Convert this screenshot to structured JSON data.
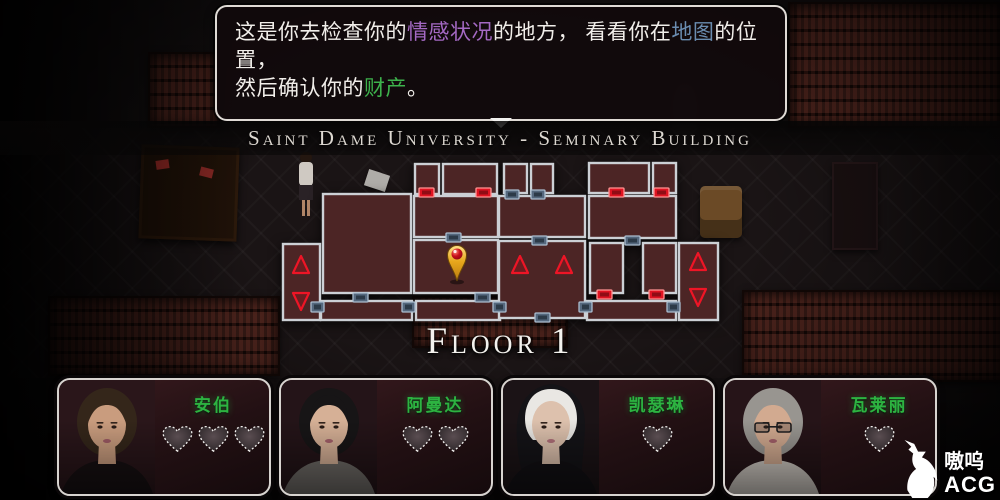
{
  "tooltip": {
    "lines": [
      [
        {
          "text": "这是你去检查你的",
          "color": "#f1eeea"
        },
        {
          "text": "情感状况",
          "color": "#a469c4"
        },
        {
          "text": "的地方， 看看你在",
          "color": "#f1eeea"
        },
        {
          "text": "地图",
          "color": "#6a8cb0"
        },
        {
          "text": "的位置，",
          "color": "#f1eeea"
        }
      ],
      [
        {
          "text": "然后确认你的",
          "color": "#f1eeea"
        },
        {
          "text": "财产",
          "color": "#3db24c"
        },
        {
          "text": "。",
          "color": "#f1eeea"
        }
      ]
    ]
  },
  "header": {
    "building_title": "Saint Dame University - Seminary Building"
  },
  "map": {
    "floor_label": "Floor 1",
    "room_fill": "#4c2525",
    "wall_color": "#ccd0d5",
    "door_red": "#e01422",
    "door_red_edge": "#ff9393",
    "door_red_inner": "#900d15",
    "door_slate": "#55687e",
    "door_slate_edge": "#aabdcf",
    "door_slate_inner": "#2c3a48",
    "stair_color": "#ee1526",
    "rooms": [
      [
        3,
        89,
        37,
        76
      ],
      [
        43,
        39,
        88,
        99
      ],
      [
        41,
        146,
        91,
        19
      ],
      [
        136,
        146,
        84,
        19
      ],
      [
        134,
        85,
        84,
        53
      ],
      [
        134,
        41,
        84,
        41
      ],
      [
        135,
        9,
        24,
        30
      ],
      [
        163,
        9,
        54,
        30
      ],
      [
        224,
        9,
        23,
        29
      ],
      [
        251,
        9,
        22,
        29
      ],
      [
        219,
        41,
        86,
        41
      ],
      [
        219,
        86,
        86,
        77
      ],
      [
        309,
        8,
        60,
        30
      ],
      [
        373,
        8,
        23,
        30
      ],
      [
        309,
        41,
        87,
        42
      ],
      [
        310,
        88,
        33,
        50
      ],
      [
        363,
        88,
        33,
        50
      ],
      [
        307,
        146,
        89,
        19
      ],
      [
        399,
        88,
        39,
        77
      ]
    ],
    "doors_red": [
      [
        139,
        33,
        15,
        9
      ],
      [
        196,
        33,
        15,
        9
      ],
      [
        329,
        33,
        15,
        9
      ],
      [
        374,
        33,
        15,
        9
      ],
      [
        317,
        135,
        15,
        9
      ],
      [
        369,
        135,
        15,
        9
      ]
    ],
    "doors_slate": [
      [
        166,
        78,
        15,
        9
      ],
      [
        225,
        35,
        14,
        9
      ],
      [
        251,
        35,
        14,
        9
      ],
      [
        252,
        81,
        15,
        9
      ],
      [
        345,
        81,
        15,
        9
      ],
      [
        73,
        138,
        15,
        9
      ],
      [
        195,
        138,
        15,
        9
      ],
      [
        255,
        158,
        15,
        9
      ],
      [
        31,
        147,
        13,
        10
      ],
      [
        122,
        147,
        13,
        10
      ],
      [
        213,
        147,
        13,
        10
      ],
      [
        299,
        147,
        13,
        10
      ],
      [
        387,
        147,
        13,
        10
      ]
    ],
    "stairs_up": [
      [
        21,
        110
      ],
      [
        240,
        110
      ],
      [
        284,
        110
      ],
      [
        418,
        107
      ]
    ],
    "stairs_down": [
      [
        21,
        146
      ],
      [
        418,
        142
      ]
    ],
    "pin": [
      177,
      100
    ]
  },
  "characters": [
    {
      "name": "安伯",
      "hearts": 3,
      "portrait": {
        "bg": "#2a161a",
        "hair": "#34261a",
        "skin": "#c99c7e",
        "top": "#171012",
        "lip": "#9e5a64"
      }
    },
    {
      "name": "阿曼达",
      "hearts": 2,
      "portrait": {
        "bg": "#241418",
        "hair": "#171516",
        "skin": "#d6b096",
        "top": "#6e6a66",
        "lip": "#a4606a"
      }
    },
    {
      "name": "凯瑟琳",
      "hearts": 1,
      "portrait": {
        "bg": "#1b1316",
        "hair": "#141317",
        "veil": true,
        "band": "#e9e7e3",
        "skin": "#ddc1ad",
        "top": "#121014",
        "lip": "#b07079"
      }
    },
    {
      "name": "瓦莱丽",
      "hearts": 1,
      "portrait": {
        "bg": "#261418",
        "hair": "#989590",
        "skin": "#d2aa90",
        "top": "#cdc7c0",
        "glasses": true,
        "lip": "#a4606a"
      }
    }
  ],
  "watermark": {
    "cn": "嗷呜",
    "en": "ACG"
  }
}
